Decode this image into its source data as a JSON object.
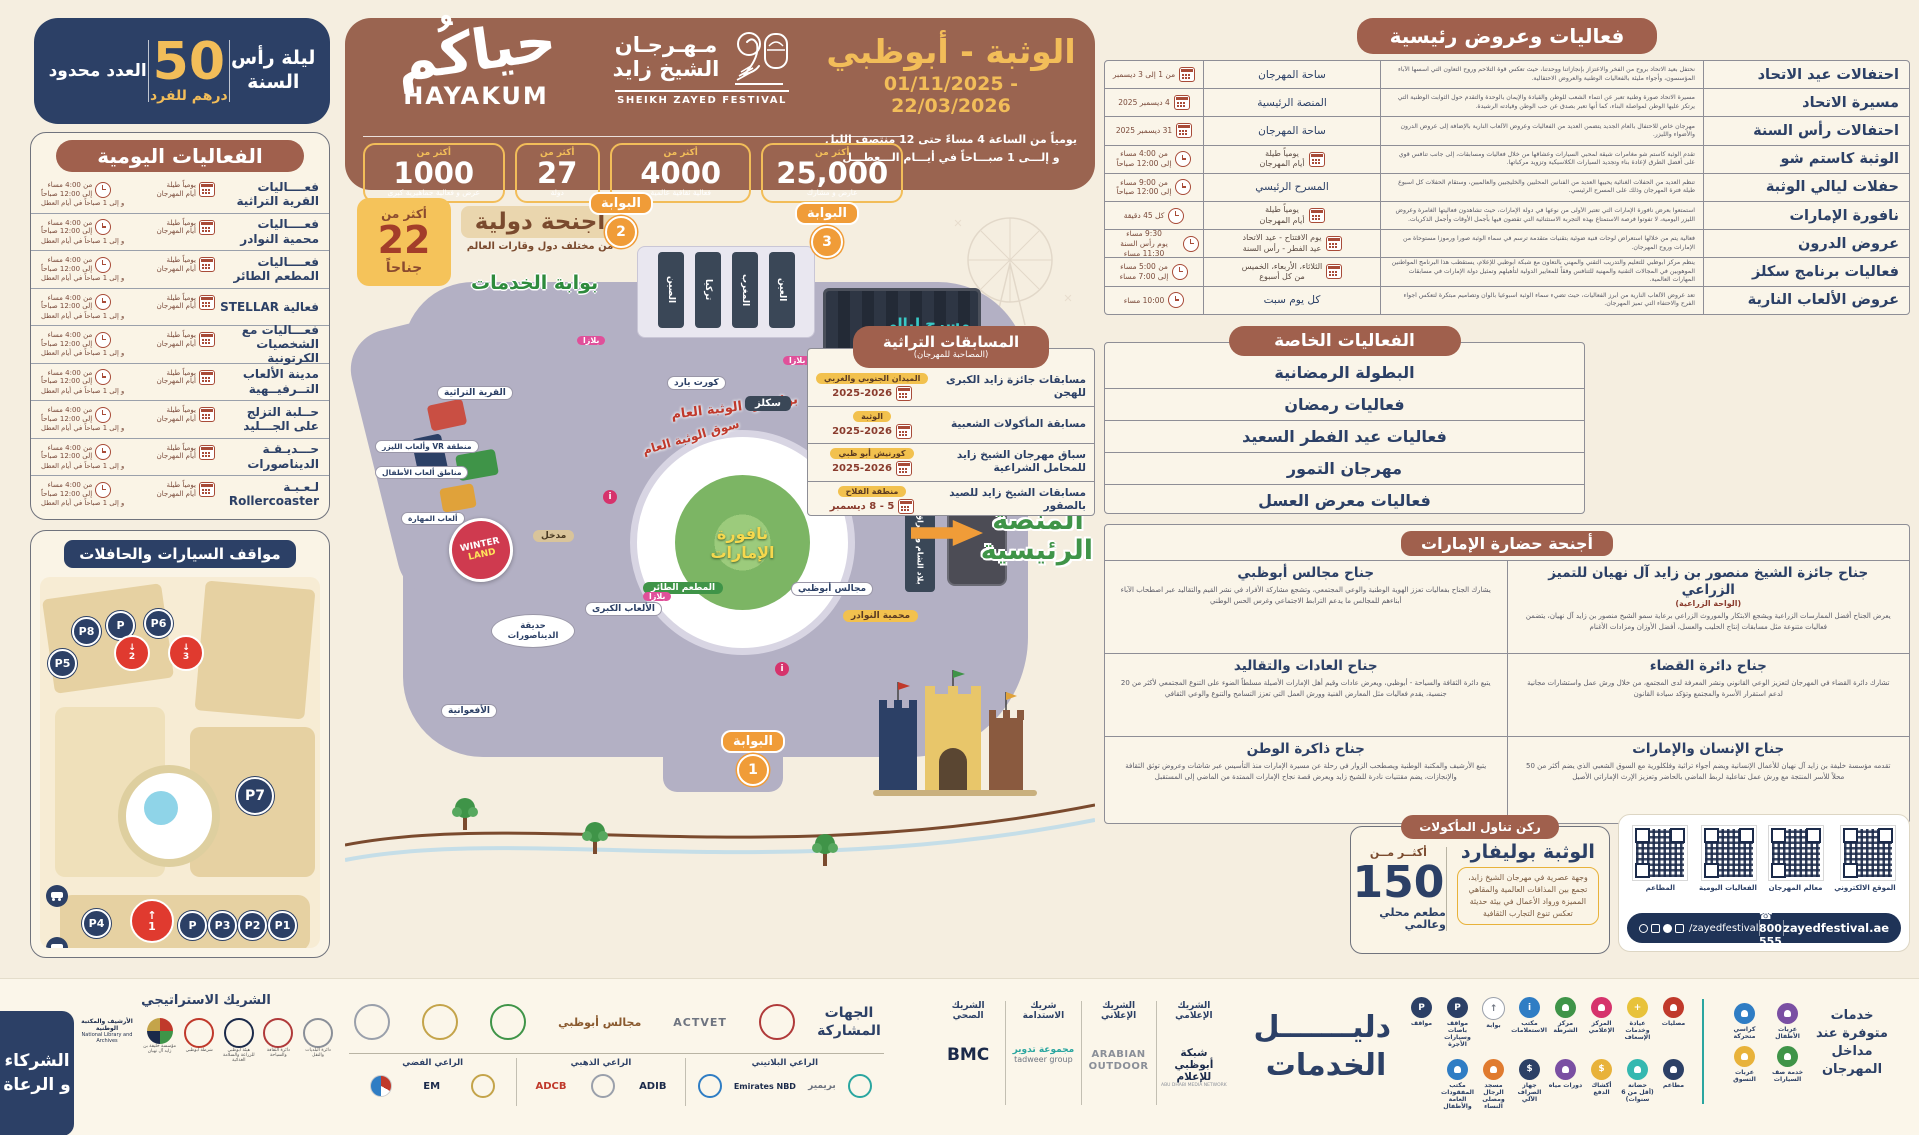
{
  "colors": {
    "navy": "#2c4066",
    "brown": "#9a6450",
    "pill": "#a0604d",
    "gold": "#f2bd59",
    "green": "#3f9448",
    "orange": "#f09c38",
    "red": "#c0392b",
    "cream": "#f5eee0"
  },
  "night_badge": {
    "line1": "ليلة رأس",
    "line2": "السنة",
    "price": "50",
    "unit": "درهم للفرد",
    "note": "العدد محدود"
  },
  "daily_events": {
    "title": "الفعاليات اليومية",
    "cal_l1": "يومياً طيلة",
    "cal_l2": "أيام المهرجان",
    "time_l1": "من 4:00 مساء",
    "time_l2": "إلى 12:00 صباحاً",
    "time_l3": "و إلى 1 صباحاً في أيام العطل",
    "items": [
      "فعــــاليات القرية التراثية",
      "فعــــاليات محمية النوادر",
      "فعــــاليات المطعم الطائر",
      "فعالية STELLAR",
      "فعـــاليات مع الشخصيات الكرتونية",
      "مدينة الألعاب التــرفيــهية",
      "حــلبة التزلج على الجـــليد",
      "حـــديـقـة الديناصورات",
      "لـعـبـة Rollercoaster"
    ]
  },
  "parking": {
    "title": "مواقف السيارات والحافلات",
    "p1": "P1",
    "p2": "P2",
    "p3": "P3",
    "p4": "P4",
    "p5": "P5",
    "p6": "P6",
    "p7": "P7",
    "p8": "P8",
    "pa": "P",
    "a1": "1",
    "a2": "2",
    "a3": "3"
  },
  "header": {
    "hayakum_ar": "حياكُم",
    "hayakum_en": "HAYAKUM",
    "festival_ar_l1": "مـهـرجـان",
    "festival_ar_l2": "الشيخ زايد",
    "festival_en": "SHEIKH ZAYED FESTIVAL",
    "location": "الوثبة - أبوظبي",
    "dates": "01/11/2025 - 22/03/2026",
    "hours_l1": "يومياً من الساعة 4 مساءً حتى 12 منتصف الليل",
    "hours_l2": "و إلـــى 1 صبـــاحاً في أيـــام الـــعطـــل",
    "more_than": "أكثر من",
    "stats": [
      {
        "value": "1000",
        "label": "عرض و فعالية جماهيرية كبرى"
      },
      {
        "value": "27",
        "label": "دولة"
      },
      {
        "value": "4000",
        "label": "فعالية ثقافية عالمية"
      },
      {
        "value": "25,000",
        "label": "عارض و مشارك"
      }
    ]
  },
  "map": {
    "gate_label": "البوابة",
    "gates": [
      "2",
      "3",
      "1"
    ],
    "badge22": {
      "more": "أكثر من",
      "num": "22",
      "suffix": "جناحاً"
    },
    "intl": {
      "title": "أجنحة دولية",
      "subtitle": "من مختلف دول وقارات العالم"
    },
    "services_gate": "بوابة الخدمات",
    "pavilions_top": [
      "العين",
      "المغرب",
      "تركيا",
      "الصين"
    ],
    "theater_l1": "مسرح ليالي",
    "theater_l2": "الوثـــبــة",
    "boulevard": "بوليفارد الوثبة العام",
    "souq": "سوق الوثبة العام",
    "fountain_l1": "نافورة",
    "fountain_l2": "الإمارات",
    "stage_l1": "المنصة",
    "stage_l2": "الرئيسية",
    "pois": {
      "courtyard": "كورت يارد",
      "skills": "سكلز",
      "levant": "بلاد الشام والعراق",
      "majalis": "مجالس أبوظبي",
      "reserve": "محمية النوادر",
      "flying_restaurant": "المطعم الطائر",
      "big_games": "الألعاب الكبرى",
      "dino": "حديقة الديناصورات",
      "coaster": "الأفعوانية",
      "entrance": "مدخل",
      "vr": "منطقة VR وألعاب الليزر",
      "kids": "مناطق ألعاب الأطفال",
      "skill_games": "ألعاب المهارة",
      "heritage_village": "القرية التراثية",
      "plaza": "بلازا",
      "winter_l1": "WINTER",
      "winter_l2": "LAND"
    }
  },
  "main_events": {
    "title": "فعاليات وعروض رئيسية",
    "rows": [
      {
        "name": "احتفالات عيد الاتحاد",
        "desc": "نحتفل بعيد الاتحاد بروح من الفخر والاعتزاز بإنجازاتنا ووحدتنا، حيث تعكس قوة التلاحم وروح التعاون التي أسسها الآباء المؤسسون، وأجواء مليئة بالفعاليات الوطنية والعروض الاحتفالية.",
        "when": "ساحة المهرجان",
        "time": "من 1 إلى 3 ديسمبر"
      },
      {
        "name": "مسيرة الاتحاد",
        "desc": "مسيرة الاتحاد صورة وطنية تعبر عن انتماء الشعب للوطن والقيادة والإيمان بالوحدة والتقدم حول الثوابت الوطنية التي يرتكز عليها الوطن لمواصلة البناء، كما أنها تعبر بصدق عن حب الوطن وقيادته الرشيدة.",
        "when": "المنصة الرئيسية",
        "time": "4 ديسمبر 2025"
      },
      {
        "name": "احتفالات رأس السنة",
        "desc": "مهرجان خاص للاحتفال بالعام الجديد يتضمن العديد من الفعاليات وعروض الألعاب النارية بالإضافة إلى عروض الدرون والأضواء والليزر.",
        "when": "ساحة المهرجان",
        "time": "31 ديسمبر 2025"
      },
      {
        "name": "الوثبة كاستم شو",
        "desc": "تقدم الوثبة كاستم شو مغامرات شيقة لمحبي السيارات وعشاقها من خلال فعاليات ومسابقات، إلى جانب تنافس قوي على أفضل الطرق لإعادة بناء وتجديد السيارات الكلاسيكية وتزويد مركباتها.",
        "when_l1": "يومياً طيلة",
        "when_l2": "أيام المهرجان",
        "time_l1": "من 4:00 مساء",
        "time_l2": "إلى 12:00 صباحاً"
      },
      {
        "name": "حفلات ليالي الوثبة",
        "desc": "تنظم العديد من الحفلات الغنائية يحييها العديد من الفنانين المحليين والخليجيين والعالميين، وستقام الحفلات كل أسبوع طيلة فترة المهرجان وذلك على المسرح الرئيسي.",
        "when": "المسرح الرئيسي",
        "time_l1": "من 9:00 مساء",
        "time_l2": "إلى 12:00 صباحاً"
      },
      {
        "name": "نافورة الإمارات",
        "desc": "استمتعوا بعرض نافورة الإمارات التي تعتبر الأولى من نوعها في دولة الإمارات، حيث تشاهدون فعاليتها الغامرة وعروض الليزر اليومية، لا تفوتوا فرصة الاستمتاع بهذه التجربة الاستثنائية التي تقضون فيها بأجمل الأوقات وأجمل الذكريات.",
        "when_l1": "يومياً طيلة",
        "when_l2": "أيام المهرجان",
        "time": "كل 45 دقيقة"
      },
      {
        "name": "عروض الدرون",
        "desc": "فعالية يتم من خلالها استعراض لوحات فنية ضوئية بتقنيات متقدمة ترسم في سماء الوثبة صوراً ورموزاً مستوحاة من الإمارات وروح المهرجان.",
        "when_l1": "يوم الافتتاح - عيد الاتحاد",
        "when_l2": "عيد الفطر - رأس السنة",
        "time_l1": "9:30 مساء",
        "time_l2": "يوم رأس السنة 11:30 مساء"
      },
      {
        "name": "فعاليات برنامج سكلز",
        "desc": "ينظم مركز أبوظبي للتعليم والتدريب التقني والمهني بالتعاون مع شبكة أبوظبي للإعلام، يستقطب هذا البرنامج المواطنين الموهوبين في المجالات التقنية والمهنية للتنافس وفقاً للمعايير الدولية لتأهيلهم وتمثيل دولة الإمارات في مسابقات المهارات العالمية.",
        "when_l1": "الثلاثاء، الأربعاء، الخميس",
        "when_l2": "من كل أسبوع",
        "time_l1": "من 5:00 مساء",
        "time_l2": "إلى 7:00 مساء"
      },
      {
        "name": "عروض الألعاب النارية",
        "desc": "تعد عروض الألعاب النارية من أبرز الفعاليات، حيث تضيء سماء الوثبة أسبوعياً بألوان وتصاميم مبتكرة لتعكس أجواء الفرح والاحتفاء التي تميز المهرجان.",
        "when": "كل يوم سبت",
        "time": "10:00 مساء"
      }
    ]
  },
  "special_events": {
    "title": "الفعاليات الخاصة",
    "items": [
      "البطولة الرمضانية",
      "فعاليات رمضان",
      "فعاليات عيد الفطر السعيد",
      "مهرجان التمور",
      "فعاليات معرض العسل"
    ]
  },
  "heritage": {
    "title": "المسابقات التراثية",
    "subtitle": "(المصاحبة للمهرجان)",
    "rows": [
      {
        "name": "مسابقات جائزة زايد الكبرى للهجن",
        "loc": "الميدان الجنوبي والغربي",
        "date": "2025-2026"
      },
      {
        "name": "مسابقة المأكولات الشعبية",
        "loc": "الوثبة",
        "date": "2025-2026"
      },
      {
        "name": "سباق مهرجان الشيخ زايد للمحامل الشراعية",
        "loc": "كورنيش أبو ظبي",
        "date": "2025-2026"
      },
      {
        "name": "مسابقات الشيخ زايد للصيد بالصقور",
        "loc": "منطقة الفلاح",
        "date": "5 - 8 ديسمبر"
      }
    ]
  },
  "pavilions": {
    "title": "أجنحة حضارة الإمارات",
    "items": [
      {
        "name": "جناح جائزة الشيخ منصور بن زايد آل نهيان للتميز الزراعي",
        "sub": "(الواحة الزراعية)",
        "desc": "يعرض الجناح أفضل الممارسات الزراعية ويشجع الابتكار والموروث الزراعي برعاية سمو الشيخ منصور بن زايد آل نهيان، يتضمن فعاليات متنوعة مثل مسابقات إنتاج الحليب والعسل، أفضل الأوزان ومزادات الأغنام"
      },
      {
        "name": "جناح مجالس أبوظبي",
        "desc": "يشارك الجناح بفعاليات تعزز الهوية الوطنية والوعي المجتمعي، وتشجع مشاركة الأفراد في نشر القيم والتقاليد عبر اصطحاب الآباء أبناءهم للمجالس ما يدعم الترابط الاجتماعي وغرس الحس الوطني"
      },
      {
        "name": "جناح دائرة القضاء",
        "desc": "تشارك دائرة القضاء في المهرجان لتعزيز الوعي القانوني ونشر المعرفة لدى المجتمع، من خلال ورش عمل واستشارات مجانية لدعم استقرار الأسرة والمجتمع وتؤكد سيادة القانون"
      },
      {
        "name": "جناح العادات والتقاليد",
        "desc": "يتبع دائرة الثقافة والسياحة - أبوظبي، ويعرض عادات وقيم أهل الإمارات الأصيلة مسلطاً الضوء على التنوع المجتمعي لأكثر من 20 جنسية، يقدم فعاليات مثل المعارض الفنية وورش العمل التي تعزز التسامح والتنوع والوعي الثقافي"
      },
      {
        "name": "جناح الإنسان والإمارات",
        "desc": "تقدمه مؤسسة خليفة بن زايد آل نهيان للأعمال الإنسانية ويضم أجواء تراثية وفلكلورية مع السوق الشعبي الذي يضم أكثر من 50 محلاً للأسر المنتجة مع ورش عمل تفاعلية لربط الماضي بالحاضر وتعزيز الإرث الإماراتي الأصيل"
      },
      {
        "name": "جناح ذاكرة الوطن",
        "desc": "يتبع الأرشيف والمكتبة الوطنية ويصطحب الزوار في رحلة عن مسيرة الإمارات منذ التأسيس عبر شاشات وعروض توثق الثقافة والإنجازات، يضم مقتنيات نادرة للشيخ زايد ويعرض قصة نجاح الإمارات الممتدة من الماضي إلى المستقبل"
      }
    ]
  },
  "food": {
    "title": "ركن تناول المأكولات",
    "name": "الوثبة بوليفارد",
    "desc": "وجهة عصرية في مهرجان الشيخ زايد، تجمع بين المذاقات العالمية والمقاهي المميزة ورواد الأعمال في بيئة حديثة تعكس تنوع التجارب الثقافية",
    "more": "أكثــر مــن",
    "value": "150",
    "label": "مطعم محلي وعالمي"
  },
  "qr": {
    "labels": [
      "الموقع الالكتروني",
      "معالم المهرجان",
      "الفعاليات اليومية",
      "المطاعم"
    ],
    "social": "/zayedfestival",
    "phone": "800 555",
    "site": "zayedfestival.ae"
  },
  "services": {
    "title_l1": "دليـــــــل",
    "title_l2": "الخدمات",
    "entrance_text": "خدمات متوفرة عند مداخل المهرجان",
    "entrance_items": [
      "عربات الأطفال",
      "كراسي متحركة",
      "خدمة صف السيارات",
      "عربات التسوق"
    ],
    "icons": [
      "مصليات",
      "عيادة وخدمات الإسعاف",
      "المركز الإعلامي",
      "مركز الشرطة",
      "مكتب الاستعلامات",
      "بوابة",
      "مواقف باصات وسيارات الأجرة",
      "مواقف",
      "مطاعم",
      "حضانة (أقل من 6 سنوات)",
      "أكشاك الدفع",
      "دورات مياه",
      "جهاز الصراف الآلي",
      "مسجد الرجال ومصلى النساء",
      "مكتب المفقودات العامة والأطفال"
    ]
  },
  "partners": {
    "cols": [
      {
        "label": "الشريك الإعلامي",
        "name": "شبكة أبوظبي للإعلام",
        "sub": "ABU DHABI MEDIA NETWORK"
      },
      {
        "label": "الشريك الإعلاني",
        "name": "ARABIAN OUTDOOR",
        "sub": ""
      },
      {
        "label": "شريك الاستدامة",
        "name": "مجموعة تدوير",
        "sub": "tadweer group"
      },
      {
        "label": "الشريك الصحي",
        "name": "BMC",
        "sub": ""
      }
    ],
    "participating_l1": "الجهات",
    "participating_l2": "المشاركة",
    "participating_names": [
      "ACTVET",
      "مجالس أبوظبي"
    ],
    "platinum": "الراعي البلاتيني",
    "gold": "الراعي الذهبي",
    "silver": "الراعي الفضي",
    "platinum_names": [
      "بريمير",
      "Emirates NBD"
    ],
    "gold_names": [
      "ADCB",
      "ADIB"
    ],
    "silver_names": [
      "pepsi",
      "EM"
    ],
    "strategic": "الشريك الاستراتيجي",
    "nla_ar": "الأرشيف والمكتبة الوطنية",
    "nla_en": "National Library and Archives",
    "strategic_names": [
      "مؤسسة خليفة بن زايد آل نهيان",
      "شرطة أبوظبي",
      "هيئة أبوظبي للزراعة والسلامة الغذائية",
      "دائرة الثقافة والسياحة",
      "دائرة البلديات والنقل"
    ],
    "box_l1": "الشركاء",
    "box_l2": "و الرعاة"
  }
}
